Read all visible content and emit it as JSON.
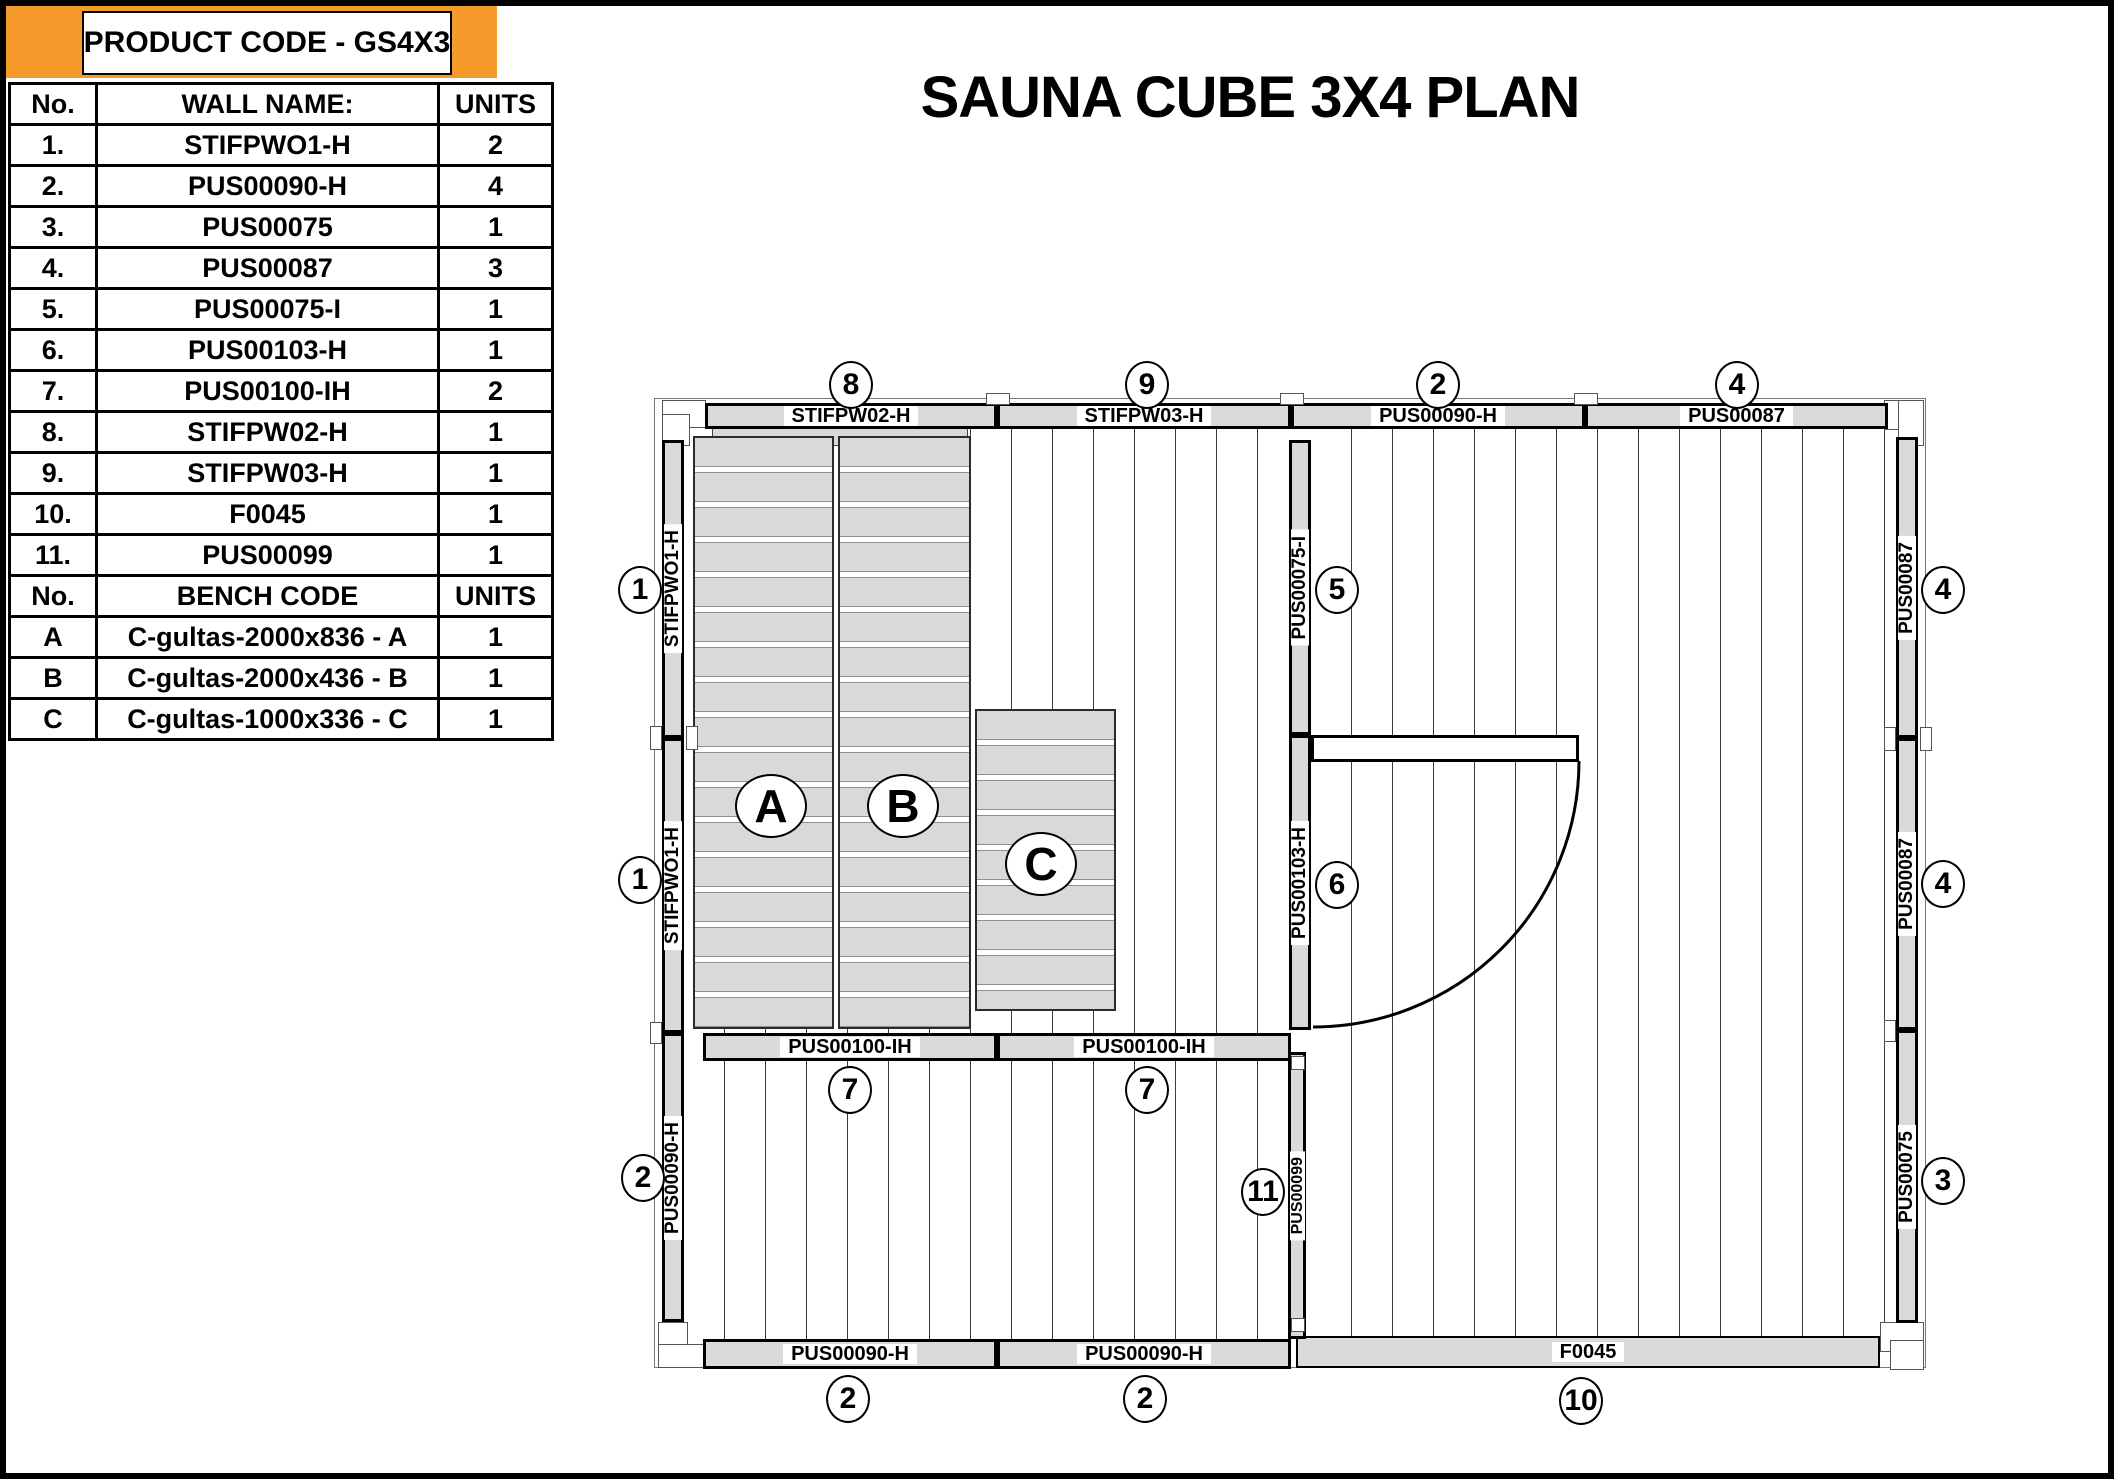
{
  "title": "SAUNA CUBE 3X4 PLAN",
  "product_header": "PRODUCT CODE - GS4X3",
  "table": {
    "wall_header": {
      "no": "No.",
      "name": "WALL NAME:",
      "units": "UNITS"
    },
    "wall_rows": [
      [
        "1.",
        "STIFPWO1-H",
        "2"
      ],
      [
        "2.",
        "PUS00090-H",
        "4"
      ],
      [
        "3.",
        "PUS00075",
        "1"
      ],
      [
        "4.",
        "PUS00087",
        "3"
      ],
      [
        "5.",
        "PUS00075-I",
        "1"
      ],
      [
        "6.",
        "PUS00103-H",
        "1"
      ],
      [
        "7.",
        "PUS00100-IH",
        "2"
      ],
      [
        "8.",
        "STIFPW02-H",
        "1"
      ],
      [
        "9.",
        "STIFPW03-H",
        "1"
      ],
      [
        "10.",
        "F0045",
        "1"
      ],
      [
        "11.",
        "PUS00099",
        "1"
      ]
    ],
    "bench_header": {
      "no": "No.",
      "name": "BENCH CODE",
      "units": "UNITS"
    },
    "bench_rows": [
      [
        "A",
        "C-gultas-2000x836 - A",
        "1"
      ],
      [
        "B",
        "C-gultas-2000x436 - B",
        "1"
      ],
      [
        "C",
        "C-gultas-1000x336 - C",
        "1"
      ]
    ]
  },
  "plan": {
    "top_wall": [
      {
        "label": "STIFPW02-H",
        "circle": "8"
      },
      {
        "label": "STIFPW03-H",
        "circle": "9"
      },
      {
        "label": "PUS00090-H",
        "circle": "2"
      },
      {
        "label": "PUS00087",
        "circle": "4"
      }
    ],
    "left_wall": [
      {
        "label": "STIFPWO1-H",
        "circle": "1"
      },
      {
        "label": "STIFPWO1-H",
        "circle": "1"
      },
      {
        "label": "PUS00090-H",
        "circle": "2"
      }
    ],
    "right_wall": [
      {
        "label": "PUS00087",
        "circle": "4"
      },
      {
        "label": "PUS00087",
        "circle": "4"
      },
      {
        "label": "PUS00075",
        "circle": "3"
      }
    ],
    "mid_wall": [
      {
        "label": "PUS00075-I",
        "circle": "5"
      },
      {
        "label": "PUS00103-H",
        "circle": "6"
      }
    ],
    "front_wall": [
      {
        "label": "PUS00100-IH",
        "circle": "7"
      },
      {
        "label": "PUS00100-IH",
        "circle": "7"
      }
    ],
    "bottom_wall": [
      {
        "label": "PUS00090-H",
        "circle": "2"
      },
      {
        "label": "PUS00090-H",
        "circle": "2"
      },
      {
        "label": "F0045",
        "circle": "10"
      }
    ],
    "inner_wall": {
      "label": "PUS00099",
      "circle": "11"
    },
    "benches": [
      {
        "label": "A"
      },
      {
        "label": "B"
      },
      {
        "label": "C"
      }
    ]
  },
  "colors": {
    "orange": "#F59B2B",
    "wall_fill": "#DADADA",
    "plank_line": "#3C3C3C"
  }
}
